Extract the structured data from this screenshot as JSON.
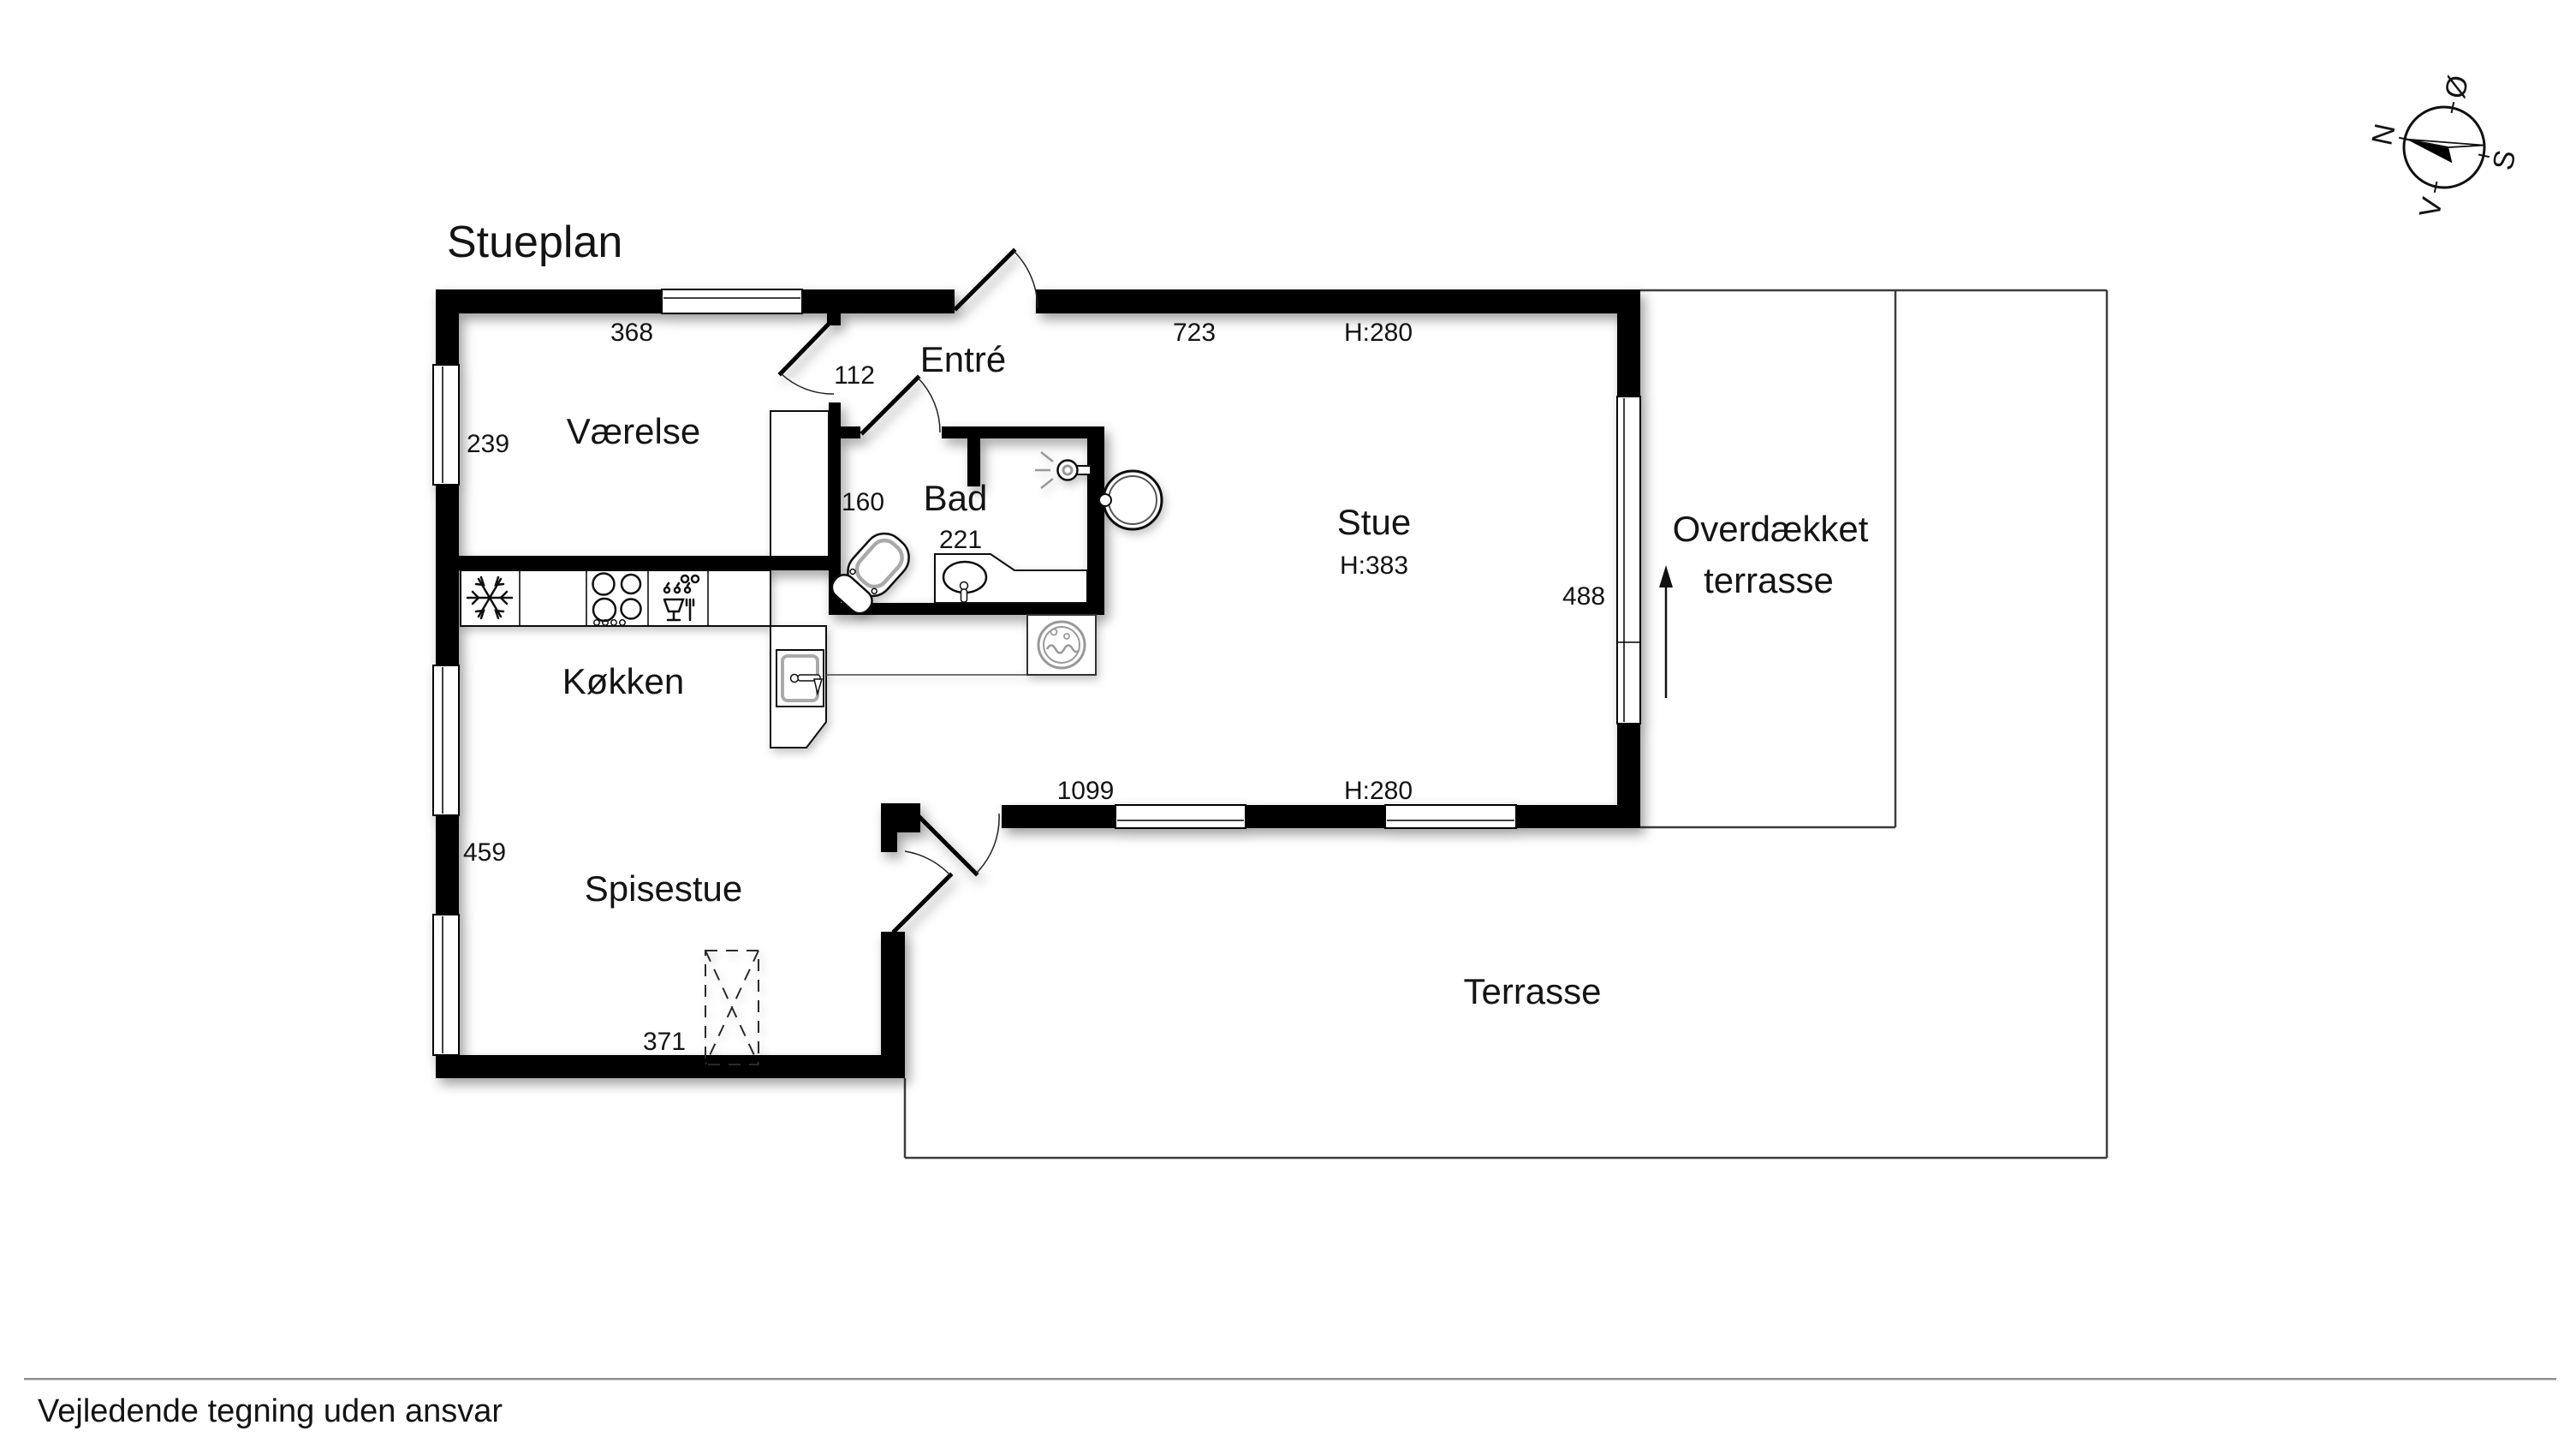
{
  "title": "Stueplan",
  "footer": {
    "disclaimer": "Vejledende tegning uden ansvar"
  },
  "rooms": {
    "vaerelse": "Værelse",
    "entre": "Entré",
    "bad": "Bad",
    "stue": "Stue",
    "koekken": "Køkken",
    "spisestue": "Spisestue",
    "covered_terrace_line1": "Overdækket",
    "covered_terrace_line2": "terrasse",
    "terrace": "Terrasse"
  },
  "dimensions": {
    "vaerelse_width": "368",
    "stue_top_width": "723",
    "stue_top_height": "H:280",
    "entre_passage": "112",
    "vaerelse_depth": "239",
    "bad_left": "160",
    "bad_width": "221",
    "stue_ceiling": "H:383",
    "stue_door_width": "488",
    "stue_bottom_width": "1099",
    "stue_bottom_height": "H:280",
    "spisestue_depth": "459",
    "spisestue_width": "371"
  },
  "compass": {
    "north": "N",
    "east": "Ø",
    "south": "S",
    "west": "V"
  }
}
